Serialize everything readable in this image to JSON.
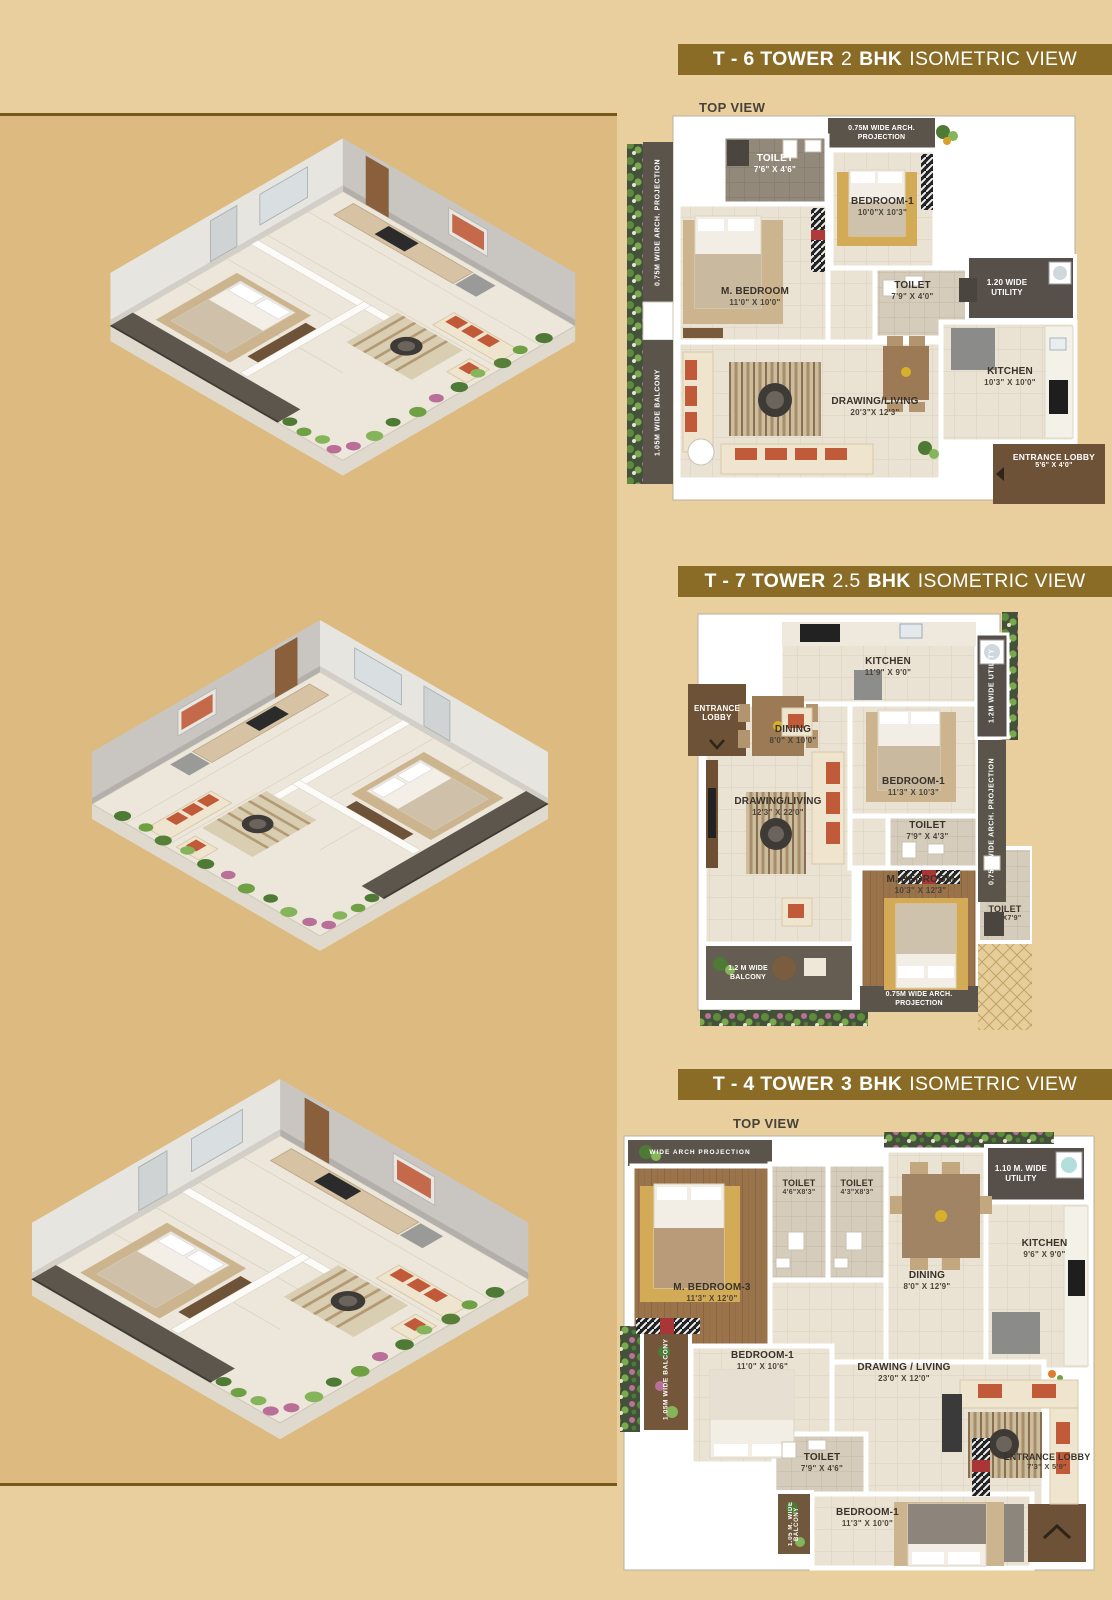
{
  "page": {
    "bg": "#e9cf9e",
    "panel_bg": "#dcba80",
    "panel_border": "#75591a",
    "banner_bg": "#8a6c26"
  },
  "sections": [
    {
      "banner": {
        "tower": "T - 6 TOWER",
        "size": "2",
        "bhk": "BHK",
        "view": "ISOMETRIC VIEW"
      },
      "top_view": "TOP VIEW",
      "rooms": [
        {
          "n": "TOILET",
          "d": "7'6\" X 4'6\""
        },
        {
          "n": "BEDROOM-1",
          "d": "10'0\"X 10'3\""
        },
        {
          "n": "M. BEDROOM",
          "d": "11'0\" X 10'0\""
        },
        {
          "n": "TOILET",
          "d": "7'9\" X 4'0\""
        },
        {
          "n": "KITCHEN",
          "d": "10'3\" X 10'0\""
        },
        {
          "n": "DRAWING/LIVING",
          "d": "20'3\"X 12'3\""
        },
        {
          "n": "ENTRANCE LOBBY",
          "d": "5'6\" X 4'0\""
        }
      ],
      "strips": {
        "arch_top_1": "0.75M WIDE ARCH.",
        "arch_top_2": "PROJECTION",
        "arch_left": "0.75M WIDE ARCH. PROJECTION",
        "balcony_left": "1.05M WIDE BALCONY",
        "utility_1": "1.20 WIDE",
        "utility_2": "UTILITY"
      }
    },
    {
      "banner": {
        "tower": "T - 7 TOWER",
        "size": "2.5",
        "bhk": "BHK",
        "view": "ISOMETRIC VIEW"
      },
      "top_view": "TOP VIEW",
      "rooms": [
        {
          "n": "KITCHEN",
          "d": "11'9\" X 9'0\""
        },
        {
          "n": "DINING",
          "d": "8'0\" X 10'0\""
        },
        {
          "n": "DRAWING/LIVING",
          "d": "12'3\" X 22'0\""
        },
        {
          "n": "BEDROOM-1",
          "d": "11'3\" X 10'3\""
        },
        {
          "n": "TOILET",
          "d": "7'9\" X 4'3\""
        },
        {
          "n": "M. BEDROOM",
          "d": "10'3\" X 12'3\""
        },
        {
          "n": "TOILET",
          "d": "4'6\"X7'9\""
        },
        {
          "n": "ENTRANCE",
          "d": "LOBBY"
        }
      ],
      "strips": {
        "utility": "1.2M WIDE UTILITY",
        "arch_right": "0.75M WIDE ARCH. PROJECTION",
        "balcony_1": "1.2 M WIDE",
        "balcony_2": "BALCONY",
        "arch_bottom_1": "0.75M WIDE ARCH.",
        "arch_bottom_2": "PROJECTION"
      }
    },
    {
      "banner": {
        "tower": "T - 4 TOWER",
        "size": "3",
        "bhk": "BHK",
        "view": "ISOMETRIC VIEW"
      },
      "top_view": "TOP VIEW",
      "rooms": [
        {
          "n": "M. BEDROOM-3",
          "d": "11'3\" X 12'0\""
        },
        {
          "n": "TOILET",
          "d": "4'6\"X8'3\""
        },
        {
          "n": "TOILET",
          "d": "4'3\"X8'3\""
        },
        {
          "n": "DINING",
          "d": "8'0\" X 12'9\""
        },
        {
          "n": "KITCHEN",
          "d": "9'6\" X 9'0\""
        },
        {
          "n": "BEDROOM-1",
          "d": "11'0\" X 10'6\""
        },
        {
          "n": "DRAWING / LIVING",
          "d": "23'0\" X 12'0\""
        },
        {
          "n": "TOILET",
          "d": "7'9\" X 4'6\""
        },
        {
          "n": "BEDROOM-1",
          "d": "11'3\" X 10'0\""
        },
        {
          "n": "ENTRANCE LOBBY",
          "d": "7'3\" X 5'9\""
        }
      ],
      "strips": {
        "arch_top": "WIDE ARCH PROJECTION",
        "utility_1": "1.10 M. WIDE",
        "utility_2": "UTILITY",
        "balcony_left": "1.05M WIDE BALCONY",
        "balcony_bottom": "1.05 M. WIDE BALCONY"
      }
    }
  ]
}
